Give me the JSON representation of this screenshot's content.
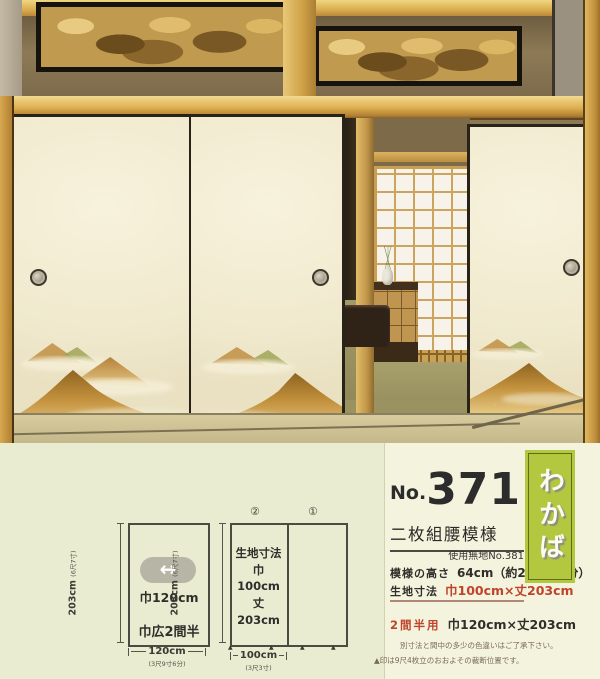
{
  "theme": {
    "panel_bg": "#e9ecd1",
    "card_bg": "#f4f3dd",
    "label_green": "#b3c83e",
    "accent_red": "#c0432b",
    "text_dark": "#2c2c2c"
  },
  "diagram_wide": {
    "height_label": "203cm",
    "height_sub": "(6尺7寸)",
    "arrow_icon": "↔",
    "width_arrow_label": "巾120cm",
    "name_label": "巾広2間半",
    "bottom_dim": "120cm",
    "bottom_dim_sub": "(3尺9寸6分)"
  },
  "diagram_panels": {
    "panel2_mark": "②",
    "panel1_mark": "①",
    "height_label": "203cm",
    "height_sub": "(6尺7寸)",
    "cell_title": "生地寸法",
    "cell_width": "巾100cm",
    "cell_height": "丈203cm",
    "cut_mark": "▲",
    "bottom_dim": "100cm",
    "bottom_dim_sub": "(3尺3寸)"
  },
  "product": {
    "no_prefix": "No.",
    "number": "371",
    "pattern_name": "二枚組腰模様",
    "plain_ref": "使用無地No.381",
    "spec1_label": "模様の高さ",
    "spec1_value": "64cm（約2尺1寸1分）",
    "spec2_label": "生地寸法",
    "spec2_value": "巾100cm×丈203cm",
    "option_label": "2間半用",
    "option_value": "巾120cm×丈203cm",
    "note1": "別寸法と間中の多少の色違いはご了承下さい。",
    "note2": "▲印は9尺4枚立のおおよその裁断位置です。"
  },
  "series_label": {
    "name": "わかば"
  }
}
